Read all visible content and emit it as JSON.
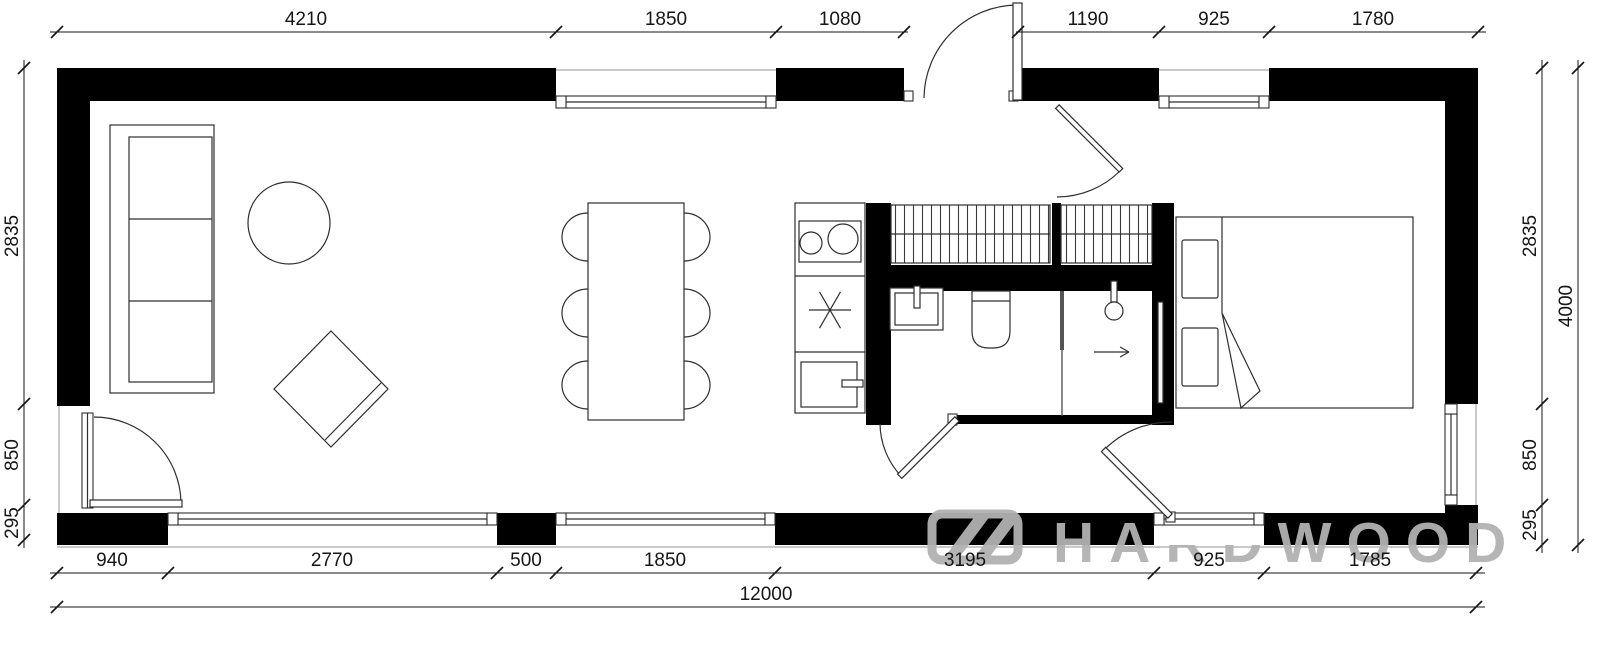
{
  "title": "apartment-floor-plan",
  "dimensions": {
    "top": [
      "4210",
      "1850",
      "1080",
      "1190",
      "925",
      "1780"
    ],
    "bottom": [
      "940",
      "2770",
      "500",
      "1850",
      "3195",
      "925",
      "1785"
    ],
    "bottom_total": "12000",
    "left": [
      "2835",
      "850",
      "295"
    ],
    "right": [
      "2835",
      "850",
      "295"
    ],
    "right_total": "4000"
  },
  "watermark": {
    "text": "HARDWOOD",
    "logo": "hardwood-logo"
  },
  "colors": {
    "wall": "#000000",
    "line": "#2e2e2e",
    "dimension": "#161616",
    "watermark": "#b2b2b2",
    "sill": "#c9c9c9"
  }
}
